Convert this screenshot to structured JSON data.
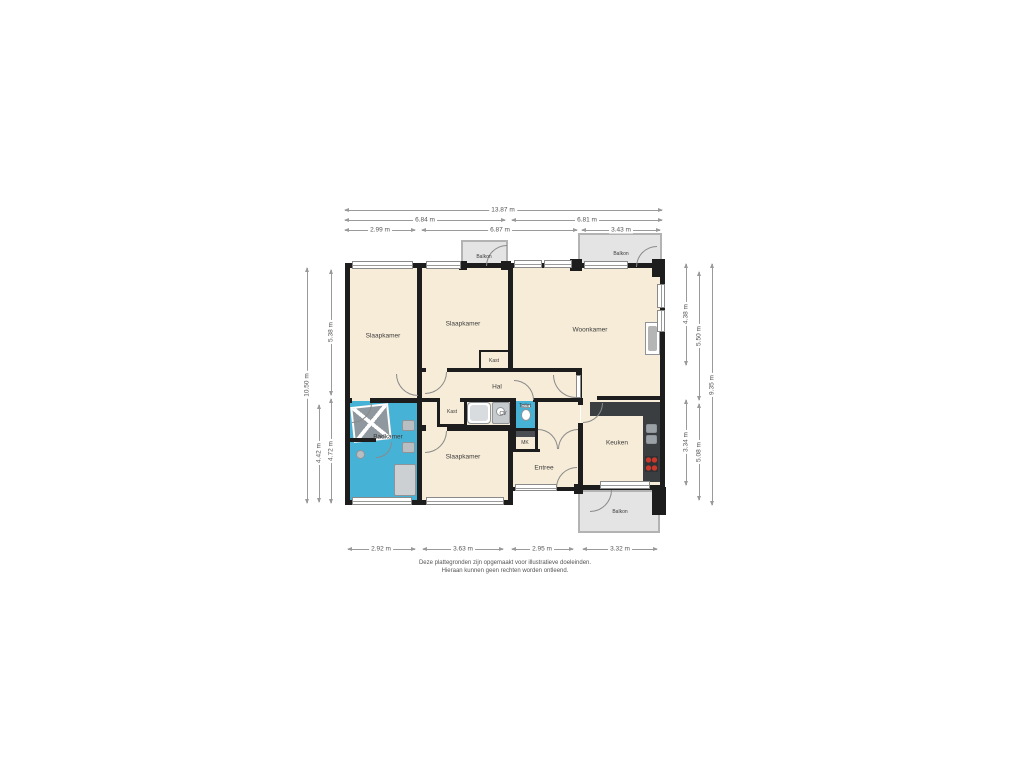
{
  "plan": {
    "type": "floorplan",
    "colors": {
      "wall": "#1d1d1d",
      "room_fill": "#f7ecd8",
      "wet_room_fill": "#46b3d6",
      "balcony_fill": "#e4e4e4",
      "dimension_line": "#9a9a9a",
      "kitchen_counter": "#3a3e41",
      "burner_red": "#c9382a"
    }
  },
  "rooms": {
    "slaapkamer1": {
      "label": "Slaapkamer"
    },
    "slaapkamer2": {
      "label": "Slaapkamer"
    },
    "woonkamer": {
      "label": "Woonkamer"
    },
    "hal": {
      "label": "Hal"
    },
    "kast_sk2": {
      "label": "Kast"
    },
    "kast_hal": {
      "label": "Kast"
    },
    "cv": {
      "label": "CV"
    },
    "toilet": {
      "label": "Toilet"
    },
    "mk": {
      "label": "MK"
    },
    "badkamer": {
      "label": "Badkamer"
    },
    "slaapkamer3": {
      "label": "Slaapkamer"
    },
    "entree": {
      "label": "Entree"
    },
    "keuken": {
      "label": "Keuken"
    },
    "balkon_top_klein": {
      "label": "Balkon"
    },
    "balkon_top_groot": {
      "label": "Balkon"
    },
    "balkon_onder": {
      "label": "Balkon"
    }
  },
  "dimensions": {
    "top": [
      "13.87 m",
      "6.84 m",
      "6.81 m",
      "2.99 m",
      "6.87 m",
      "3.43 m"
    ],
    "bottom": [
      "2.92 m",
      "3.63 m",
      "2.95 m",
      "3.32 m"
    ],
    "left": [
      "10.50 m",
      "5.38 m",
      "4.42 m",
      "4.72 m"
    ],
    "right": [
      "4.38 m",
      "5.50 m",
      "5.08 m",
      "3.34 m",
      "9.35 m"
    ]
  },
  "disclaimer": {
    "line1": "Deze plattegronden zijn opgemaakt voor illustratieve doeleinden.",
    "line2": "Hieraan kunnen geen rechten worden ontleend."
  }
}
